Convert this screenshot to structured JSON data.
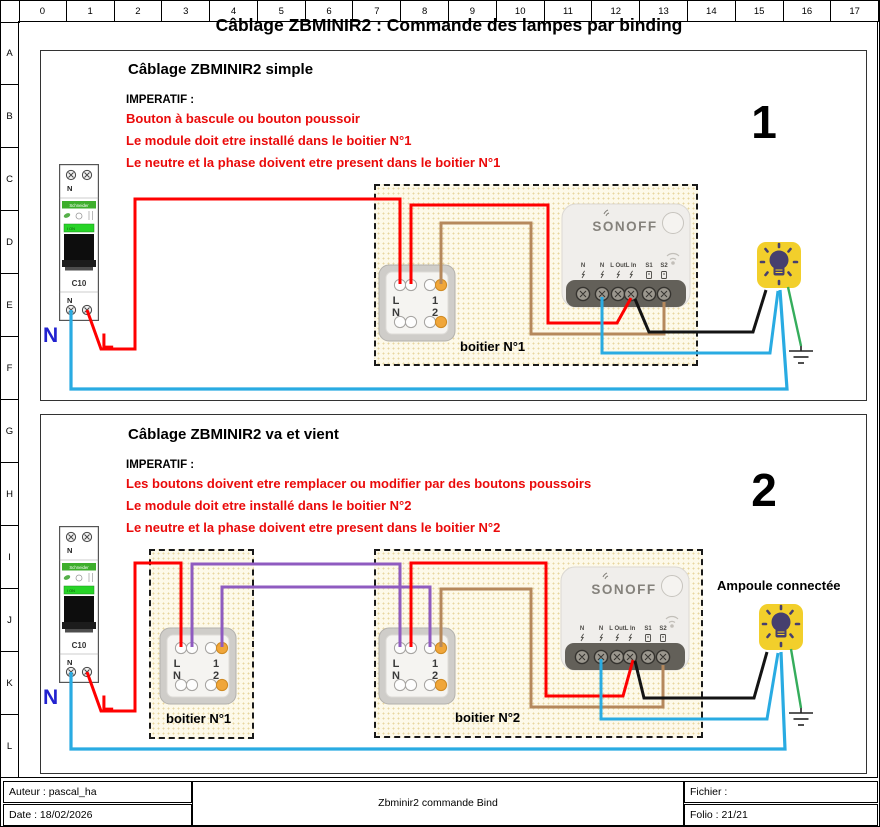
{
  "sheet": {
    "title": "Câblage ZBMINIR2 : Commande des lampes par binding",
    "ruler_cols": [
      "0",
      "1",
      "2",
      "3",
      "4",
      "5",
      "6",
      "7",
      "8",
      "9",
      "10",
      "11",
      "12",
      "13",
      "14",
      "15",
      "16",
      "17"
    ],
    "ruler_rows": [
      "A",
      "B",
      "C",
      "D",
      "E",
      "F",
      "G",
      "H",
      "I",
      "J",
      "K",
      "L"
    ]
  },
  "panel1": {
    "number": "1",
    "title": "Câblage ZBMINIR2  simple",
    "imperatif_label": "IMPERATIF :",
    "warnings": [
      "Bouton à bascule ou bouton poussoir",
      "Le module doit etre installé dans le boitier N°1",
      "Le neutre et la phase doivent etre present dans le boitier N°1"
    ],
    "box_label": "boitier N°1",
    "neutral_label": "N",
    "line_label": "L"
  },
  "panel2": {
    "number": "2",
    "title": "Câblage ZBMINIR2  va et vient",
    "imperatif_label": "IMPERATIF :",
    "warnings": [
      "Les boutons doivent etre remplacer ou modifier par des boutons poussoirs",
      "Le module doit etre installé dans le boitier N°2",
      "Le neutre et la phase doivent etre present dans le boitier N°2"
    ],
    "box1_label": "boitier N°1",
    "box2_label": "boitier N°2",
    "lamp_label": "Ampoule connectée",
    "neutral_label": "N",
    "line_label": "L"
  },
  "breaker": {
    "brand": "Schneider",
    "model": "C10",
    "top_label": "N",
    "bottom_label": "N",
    "on_label": "I ON"
  },
  "switch": {
    "l": "L",
    "n": "N",
    "one": "1",
    "two": "2"
  },
  "sonoff": {
    "logo": "SONOFF",
    "terminals": [
      "N",
      "N",
      "L Out",
      "L In",
      "S1",
      "S2"
    ]
  },
  "titleblock": {
    "author": "Auteur : pascal_ha",
    "date": "Date : 18/02/2026",
    "center": "Zbminir2 commande Bind",
    "file": "Fichier :",
    "folio": "Folio : 21/21"
  },
  "colors": {
    "phase_wire": "#ff0000",
    "neutral_wire": "#29abe2",
    "shuttle_wire": "#8f5bc0",
    "s2_wire": "#b5885c",
    "lamp_feed_wire": "#141414",
    "earth_wire": "#35ad5c",
    "warning_text": "#ea0a0a",
    "lamp_body": "#f2cf2b",
    "terminal_orange": "#f0a63a"
  }
}
